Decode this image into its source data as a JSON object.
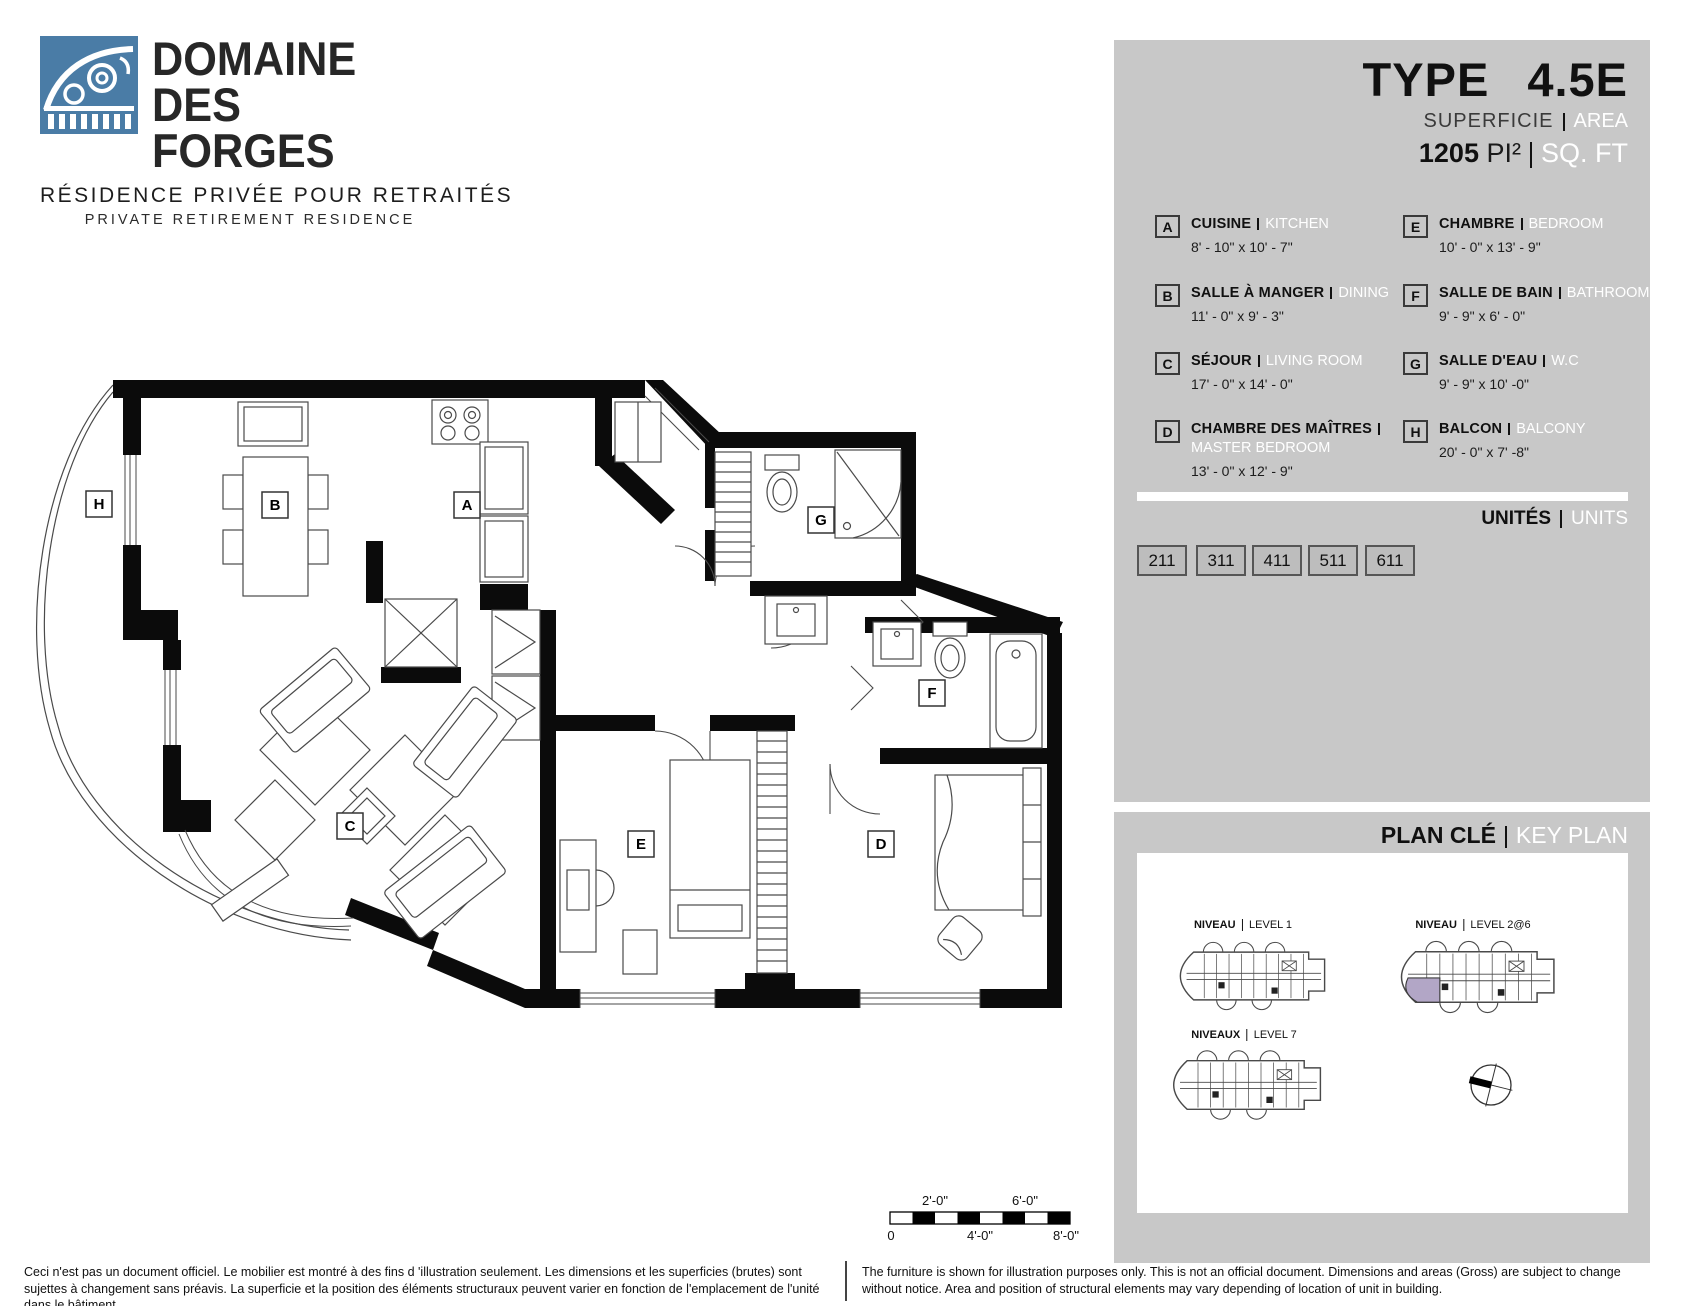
{
  "logo": {
    "line1": "DOMAINE",
    "line2": "DES FORGES",
    "sub_fr": "RÉSIDENCE PRIVÉE POUR RETRAITÉS",
    "sub_en": "PRIVATE RETIREMENT RESIDENCE"
  },
  "header": {
    "type_label": "TYPE",
    "type_value": "4.5E",
    "superficie_label": "SUPERFICIE",
    "area_label": "AREA",
    "area_value": "1205",
    "area_unit_fr": "PI²",
    "area_unit_en": "SQ. FT"
  },
  "legend": {
    "items": [
      {
        "key": "A",
        "fr": "CUISINE",
        "en": "KITCHEN",
        "dim": "8' - 10\" x 10' - 7\""
      },
      {
        "key": "B",
        "fr": "SALLE À MANGER",
        "en": "DINING",
        "dim": "11' - 0\" x 9' - 3\""
      },
      {
        "key": "C",
        "fr": "SÉJOUR",
        "en": "LIVING ROOM",
        "dim": "17' - 0\" x 14' - 0\""
      },
      {
        "key": "D",
        "fr": "CHAMBRE DES MAÎTRES",
        "en": "MASTER BEDROOM",
        "dim": "13' - 0\" x 12' - 9\""
      },
      {
        "key": "E",
        "fr": "CHAMBRE",
        "en": "BEDROOM",
        "dim": "10' - 0\" x 13' - 9\""
      },
      {
        "key": "F",
        "fr": "SALLE DE BAIN",
        "en": "BATHROOM",
        "dim": "9' - 9\" x 6' - 0\""
      },
      {
        "key": "G",
        "fr": "SALLE D'EAU",
        "en": "W.C",
        "dim": "9' - 9\" x 10' -0\""
      },
      {
        "key": "H",
        "fr": "BALCON",
        "en": "BALCONY",
        "dim": "20' - 0\" x 7' -8\""
      }
    ]
  },
  "units": {
    "label_fr": "UNITÉS",
    "label_en": "UNITS",
    "numbers": [
      "211",
      "311",
      "411",
      "511",
      "611"
    ]
  },
  "keyplan": {
    "title_fr": "PLAN CLÉ",
    "title_en": "KEY PLAN",
    "levels": [
      {
        "fr": "NIVEAU",
        "en": "LEVEL 1"
      },
      {
        "fr": "NIVEAU",
        "en": "LEVEL 2@6"
      },
      {
        "fr": "NIVEAUX",
        "en": "LEVEL 7"
      }
    ]
  },
  "plan": {
    "labels": [
      "H",
      "B",
      "A",
      "G",
      "F",
      "C",
      "E",
      "D"
    ]
  },
  "scalebar": {
    "top": [
      "2'-0\"",
      "6'-0\""
    ],
    "bottom": [
      "0",
      "4'-0\"",
      "8'-0\""
    ]
  },
  "footer": {
    "fr": "Ceci n'est pas un document officiel.  Le mobilier est montré à des fins d 'illustration seulement.  Les dimensions et les superficies (brutes) sont sujettes à changement sans préavis. La superficie et la position des éléments structuraux peuvent varier en fonction de l'emplacement de l'unité dans le bâtiment.",
    "en": "The furniture is shown for illustration purposes only.  This is not an official document.  Dimensions and areas (Gross) are subject to change without notice.  Area and position of structural elements may vary depending of location of unit in building."
  },
  "colors": {
    "panel_gray": "#c8c8c8",
    "logo_blue": "#4a7ca6",
    "highlight_unit_purple": "#b2a6c6",
    "wall_black": "#0b0b0b",
    "white": "#ffffff"
  }
}
